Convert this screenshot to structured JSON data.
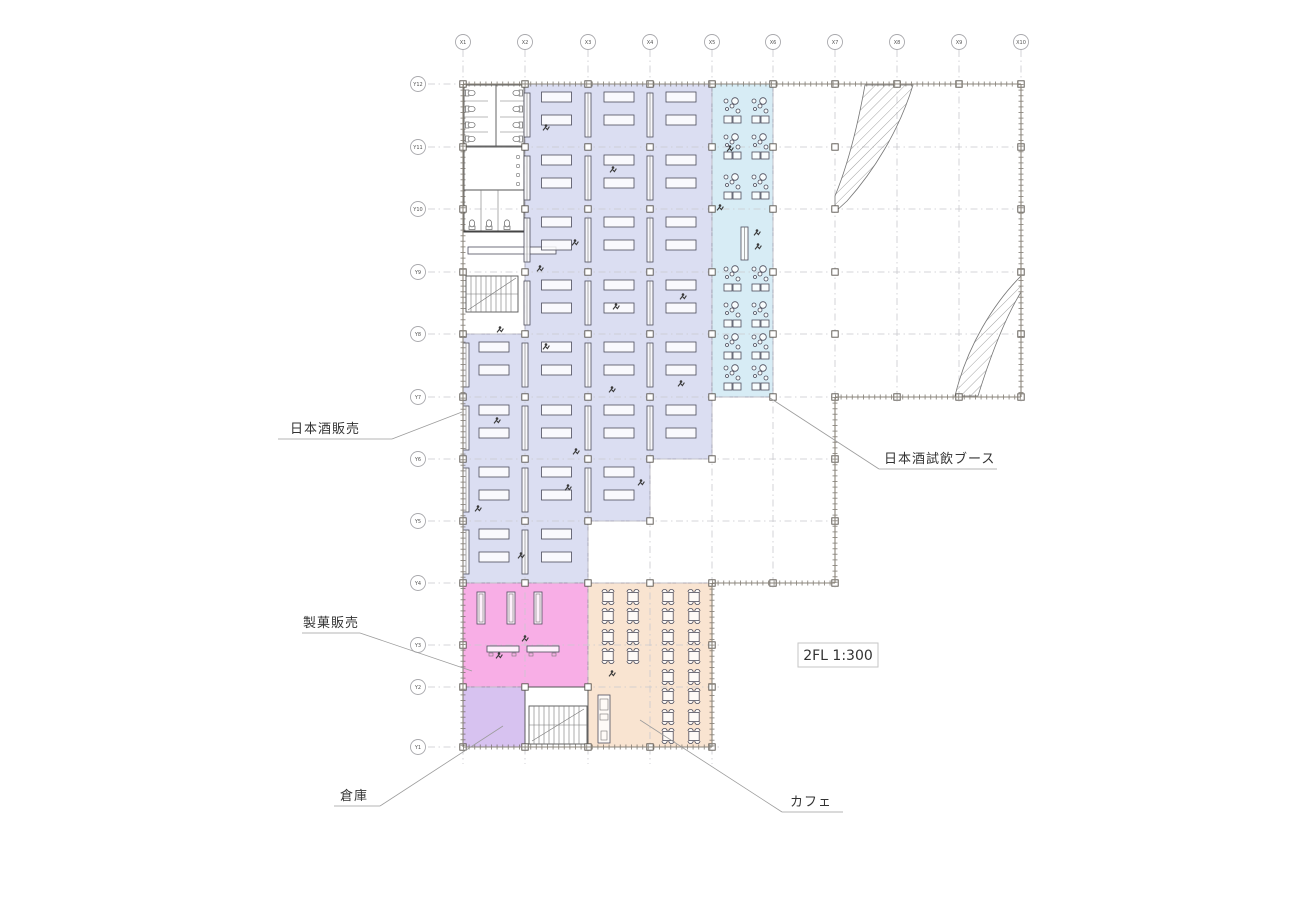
{
  "plan": {
    "scale_label": "2FL 1:300",
    "grid": {
      "x_labels": [
        "X1",
        "X2",
        "X3",
        "X4",
        "X5",
        "X6",
        "X7",
        "X8",
        "X9",
        "X10"
      ],
      "y_labels": [
        "Y12",
        "Y11",
        "Y10",
        "Y9",
        "Y8",
        "Y7",
        "Y6",
        "Y5",
        "Y4",
        "Y3",
        "Y2",
        "Y1"
      ]
    },
    "areas": {
      "sake_sales": {
        "label": "日本酒販売",
        "color": "#dbdef2"
      },
      "sake_tasting": {
        "label": "日本酒試飲ブース",
        "color": "#d7ecf5"
      },
      "confectionery": {
        "label": "製菓販売",
        "color": "#f8aee6"
      },
      "storage": {
        "label": "倉庫",
        "color": "#d7c2f0"
      },
      "cafe": {
        "label": "カフェ",
        "color": "#f9e4d1"
      }
    }
  }
}
